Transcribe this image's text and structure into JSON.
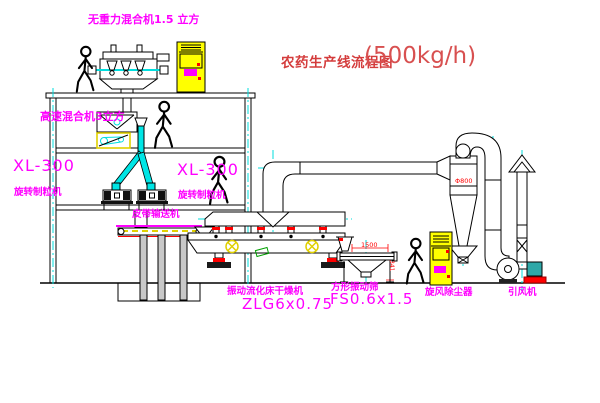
{
  "title": {
    "text": "农药生产线流程图",
    "capacity": "(500kg/h)"
  },
  "equipment_labels": {
    "gravity_mixer": "无重力混合机1.5 立方",
    "high_speed_mixer": "高速混合机3立方",
    "granulator_left_model": "XL-300",
    "granulator_left_name": "旋转制粒机",
    "granulator_right_model": "XL-300",
    "granulator_right_name": "旋转制粒机",
    "belt_conveyor": "皮带输送机",
    "dryer_name": "振动流化床干燥机",
    "dryer_model": "ZLG6x0.75",
    "sieve_name": "方形振动筛",
    "sieve_model": "FS0.6x1.5",
    "cyclone": "旋风除尘器",
    "induced_fan": "引风机"
  },
  "dimensions": {
    "sieve_length": "1500",
    "sieve_height": "341",
    "cyclone_diameter": "Φ800"
  },
  "colors": {
    "label_magenta": "#ff00ff",
    "title_red": "#d43c3c",
    "centerline_cyan": "#00dede",
    "cabinet_yellow": "#ffff00",
    "accent_red": "#ff0000",
    "line_black": "#000000"
  }
}
